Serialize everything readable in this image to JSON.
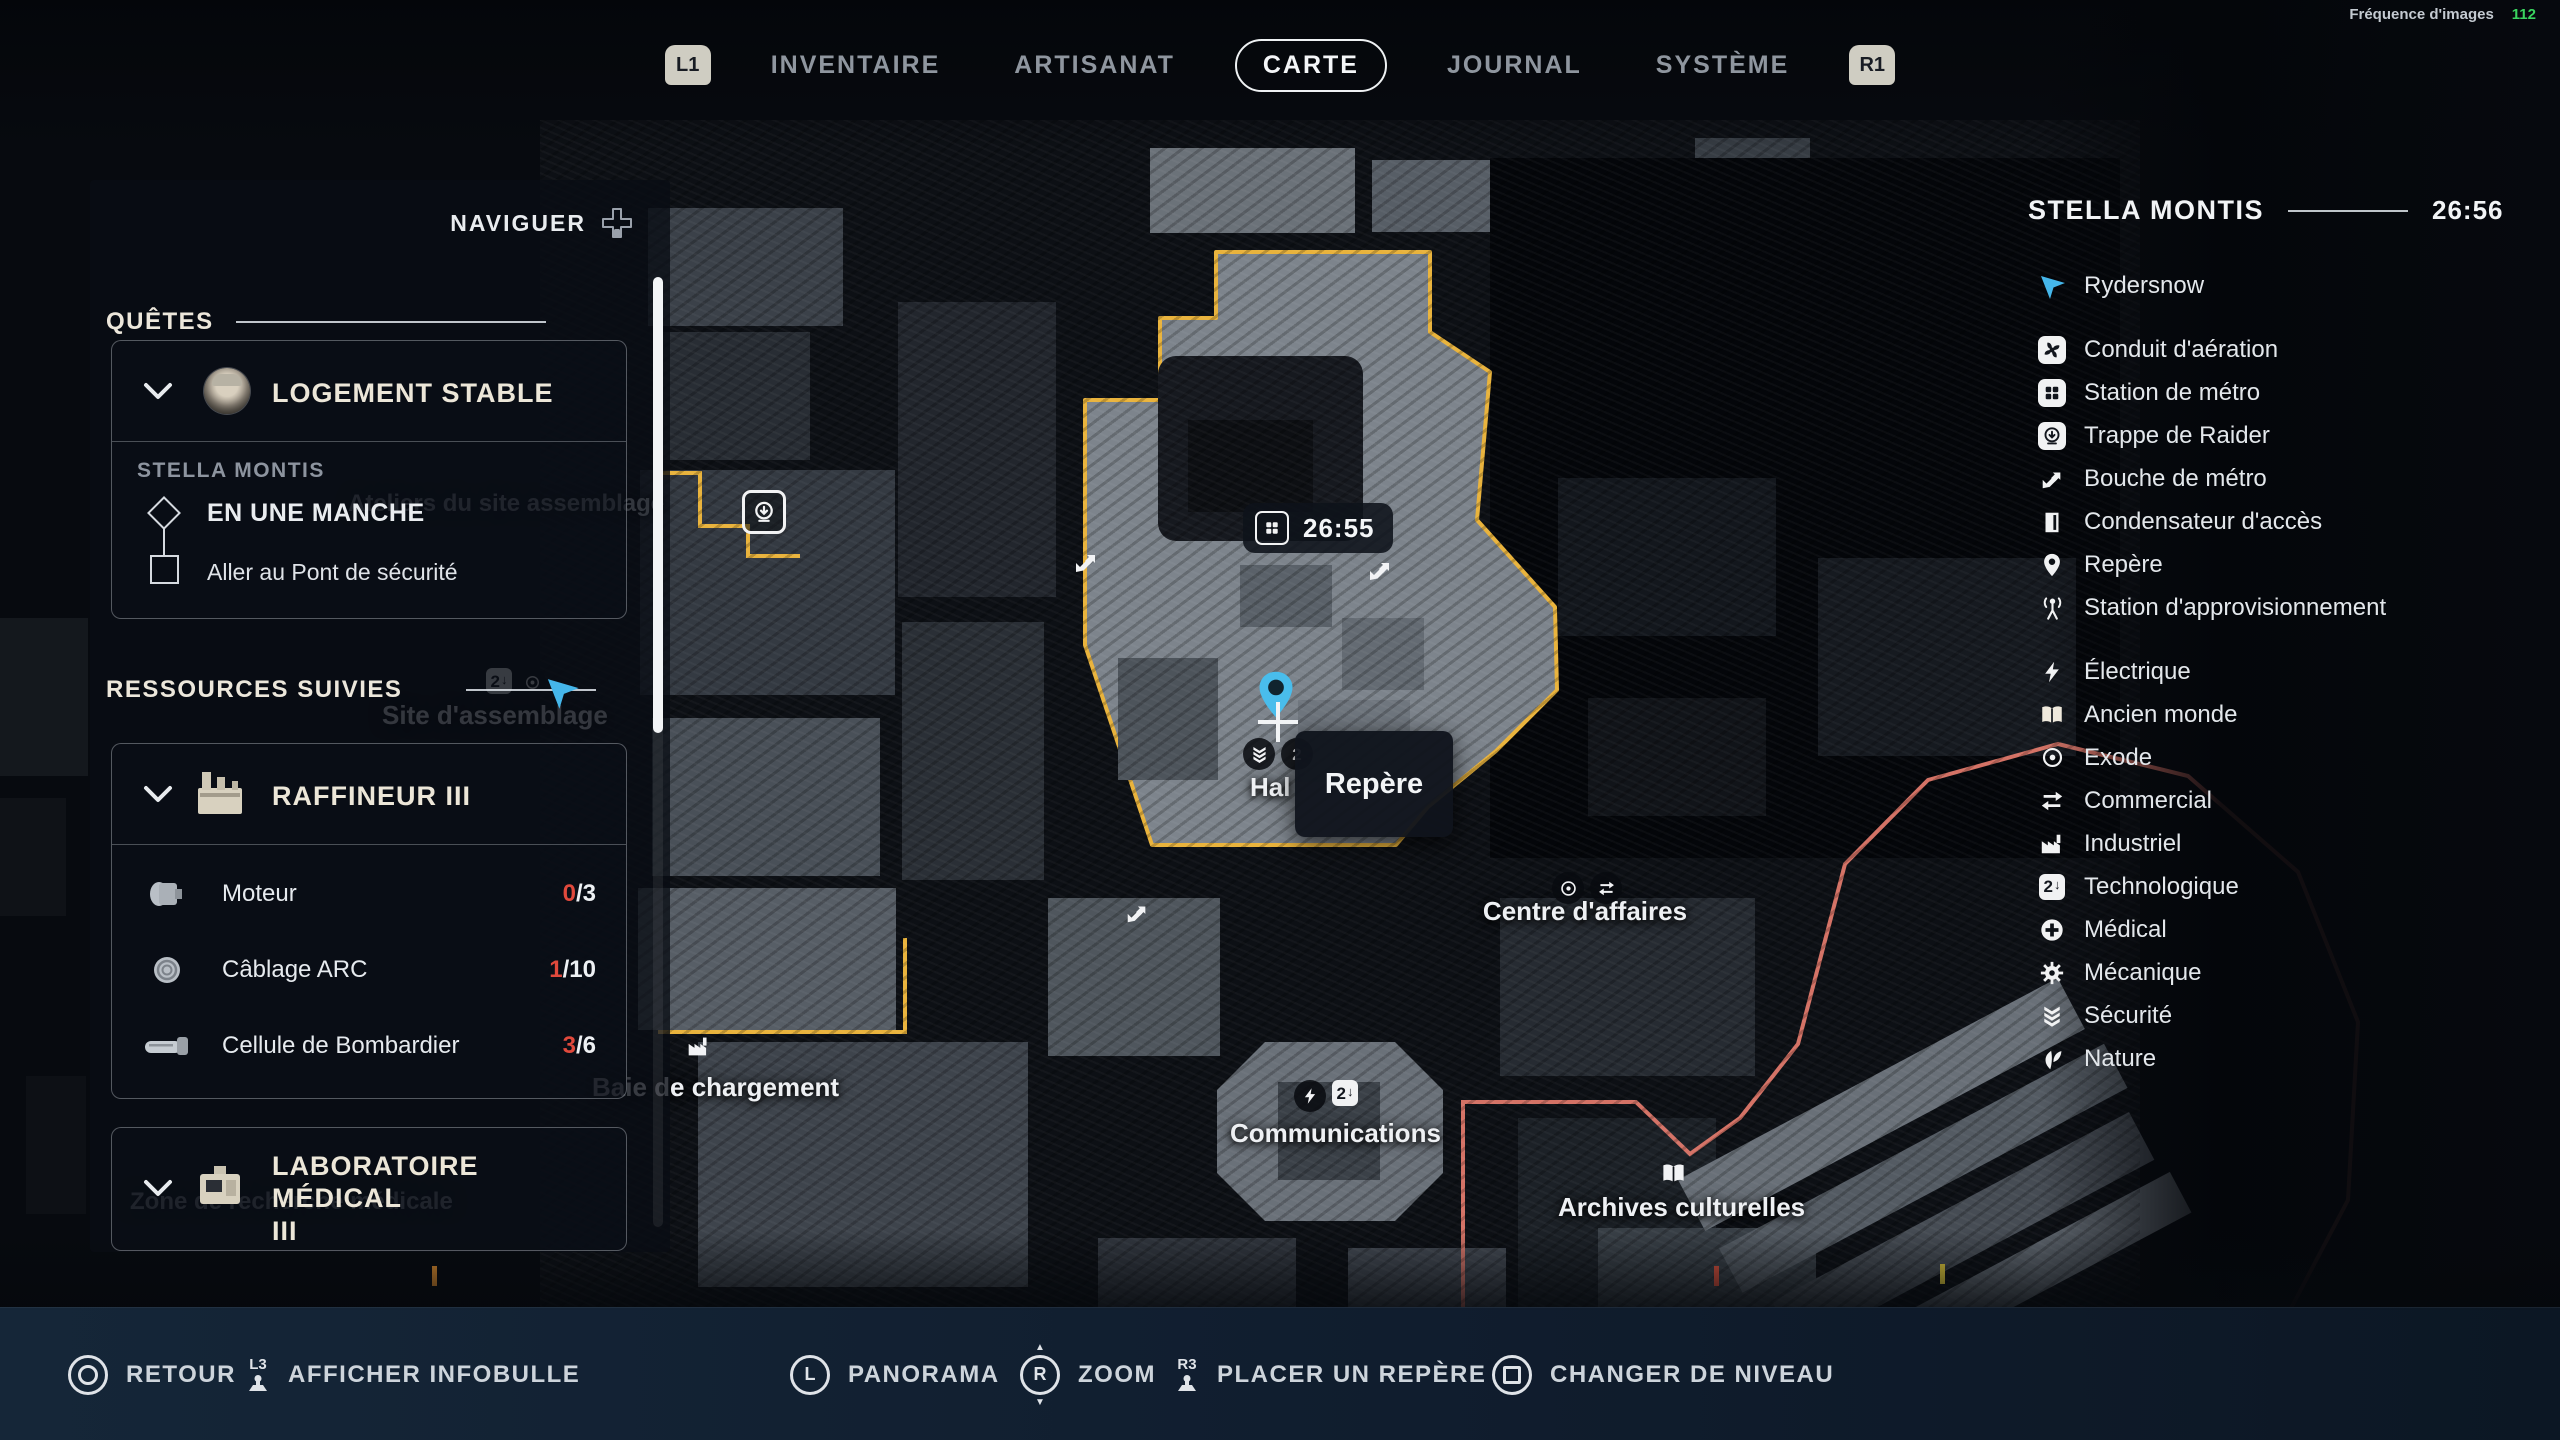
{
  "fps": {
    "label": "Fréquence d'images",
    "value": "112"
  },
  "top_nav": {
    "l1": "L1",
    "r1": "R1",
    "tabs": [
      {
        "label": "INVENTAIRE"
      },
      {
        "label": "ARTISANAT"
      },
      {
        "label": "CARTE",
        "active": true
      },
      {
        "label": "JOURNAL"
      },
      {
        "label": "SYSTÈME"
      }
    ]
  },
  "left_panel": {
    "navigate": "NAVIGUER",
    "quests_header": "QUÊTES",
    "quest": {
      "title": "LOGEMENT STABLE",
      "zone": "STELLA MONTIS",
      "stage": "EN UNE MANCHE",
      "objective": "Aller au Pont de sécurité"
    },
    "resources_header": "RESSOURCES SUIVIES",
    "refiner": {
      "title": "RAFFINEUR III",
      "items": [
        {
          "name": "Moteur",
          "have": "0",
          "of": "/3"
        },
        {
          "name": "Câblage ARC",
          "have": "1",
          "of": "/10"
        },
        {
          "name": "Cellule de Bombardier",
          "have": "3",
          "of": "/6"
        }
      ]
    },
    "lab": {
      "title_line1": "LABORATOIRE MÉDICAL",
      "title_line2": "III"
    }
  },
  "map": {
    "station_badge_time": "26:55",
    "tooltip": "Repère",
    "labels": {
      "ateliers": "Ateliers du site assemblage",
      "site_assemblage": "Site d'assemblage",
      "baie": "Baie de chargement",
      "hal": "Hal",
      "centre": "Centre d'affaires",
      "communications": "Communications",
      "archives": "Archives culturelles",
      "zone_medicale": "Zone de recherche médicale"
    }
  },
  "right_panel": {
    "title": "STELLA MONTIS",
    "time": "26:56",
    "legend": [
      {
        "icon": "player-arrow-icon",
        "label": "Rydersnow"
      },
      {
        "icon": "vent-fan-icon",
        "label": "Conduit d'aération"
      },
      {
        "icon": "metro-station-icon",
        "label": "Station de métro"
      },
      {
        "icon": "raider-hatch-icon",
        "label": "Trappe de Raider"
      },
      {
        "icon": "metro-entrance-icon",
        "label": "Bouche de métro"
      },
      {
        "icon": "access-door-icon",
        "label": "Condensateur d'accès"
      },
      {
        "icon": "map-pin-icon",
        "label": "Repère"
      },
      {
        "icon": "supply-station-icon",
        "label": "Station d'approvisionnement"
      },
      {
        "icon": "lightning-icon",
        "label": "Électrique"
      },
      {
        "icon": "old-world-book-icon",
        "label": "Ancien monde"
      },
      {
        "icon": "exodus-eye-icon",
        "label": "Exode"
      },
      {
        "icon": "commerce-arrows-icon",
        "label": "Commercial"
      },
      {
        "icon": "factory-icon",
        "label": "Industriel"
      },
      {
        "icon": "tech-icon",
        "label": "Technologique"
      },
      {
        "icon": "medical-cross-icon",
        "label": "Médical"
      },
      {
        "icon": "gear-icon",
        "label": "Mécanique"
      },
      {
        "icon": "security-chevrons-icon",
        "label": "Sécurité"
      },
      {
        "icon": "nature-leaf-icon",
        "label": "Nature"
      }
    ]
  },
  "bottom_bar": {
    "actions": [
      {
        "hint": "circle-button",
        "label": "RETOUR"
      },
      {
        "hint": "L3",
        "label": "AFFICHER INFOBULLE"
      },
      {
        "hint": "L",
        "label": "PANORAMA"
      },
      {
        "hint": "R",
        "label": "ZOOM"
      },
      {
        "hint": "R3",
        "label": "PLACER UN REPÈRE"
      },
      {
        "hint": "square-button",
        "label": "CHANGER DE NIVEAU"
      }
    ]
  },
  "colors": {
    "accent_yellow": "#e9b33c",
    "accent_salmon": "#e57b6d",
    "player_blue": "#45b6ea",
    "warning_red": "#e0493c",
    "fps_green": "#3ad45f"
  },
  "tech_glyph": {
    "digit": "2",
    "arrow": "↓"
  }
}
